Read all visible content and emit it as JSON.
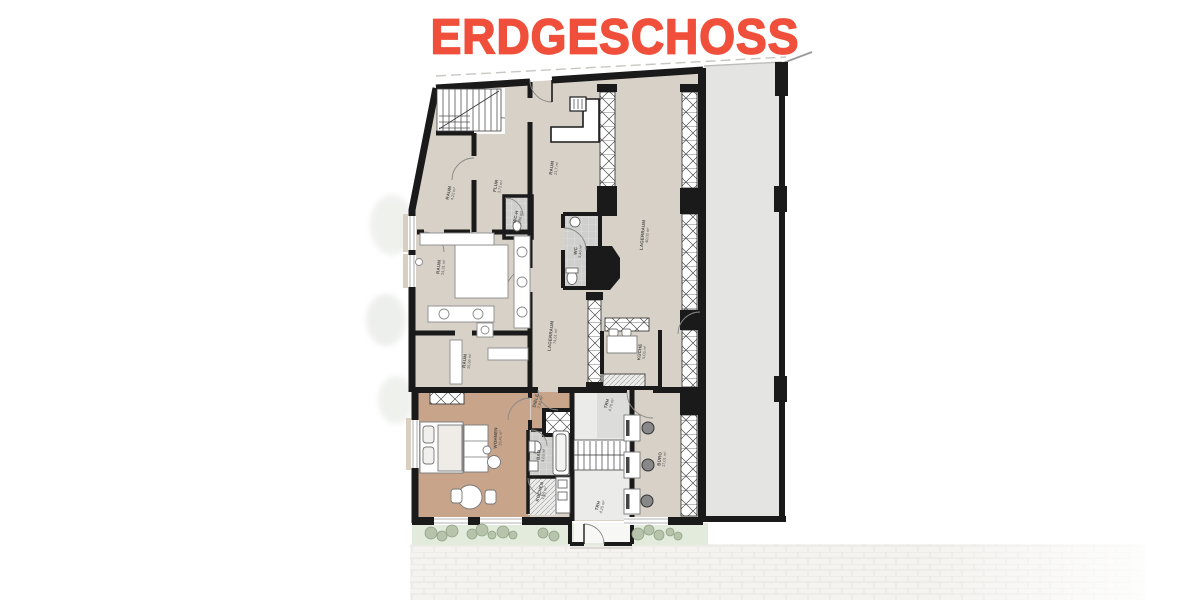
{
  "title": {
    "text": "ERDGESCHOSS"
  },
  "colors": {
    "accent": "#F0503B",
    "wall": "#1a1a1a",
    "floor_main": "#d8d1c7",
    "floor_flat": "#c7a48a",
    "floor_wet": "#cfcfcd",
    "neighbor_area": "#e4e4e2",
    "planting": "#e3ecdc",
    "paving": "#f4f3f0"
  },
  "plan": {
    "rooms": [
      {
        "id": "raum-422",
        "name": "RAUM",
        "area": "4,22 m²"
      },
      {
        "id": "flur",
        "name": "FLUR",
        "area": "3,72 m²"
      },
      {
        "id": "wc-h",
        "name": "WC-H",
        "area": "1,98 m²"
      },
      {
        "id": "raum-217",
        "name": "RAUM",
        "area": "21,7 m²"
      },
      {
        "id": "raum-2431",
        "name": "RAUM",
        "area": "24,31 m²"
      },
      {
        "id": "lager-40",
        "name": "LAGERRAUM",
        "area": "40,03 m²"
      },
      {
        "id": "wc",
        "name": "WC",
        "area": "3,40 m²"
      },
      {
        "id": "lager-74",
        "name": "LAGERRAUM",
        "area": "74,61 m²"
      },
      {
        "id": "raum-1566",
        "name": "RAUM",
        "area": "15,66 m²"
      },
      {
        "id": "kueche",
        "name": "KÜCHE",
        "area": "5,06 m²"
      },
      {
        "id": "wohnen",
        "name": "WOHNEN",
        "area": "26,41 m²"
      },
      {
        "id": "diele",
        "name": "DIELE",
        "area": "2,81 m²"
      },
      {
        "id": "bad",
        "name": "BAD",
        "area": "4,63 m²"
      },
      {
        "id": "kochen",
        "name": "KOCHEN",
        "area": "1,65 m²"
      },
      {
        "id": "trh-476",
        "name": "TRH",
        "area": "4,76 m²"
      },
      {
        "id": "trh-415",
        "name": "TRH",
        "area": "4,15 m²"
      },
      {
        "id": "buero",
        "name": "BÜRO",
        "area": "17,01 m²"
      }
    ]
  }
}
